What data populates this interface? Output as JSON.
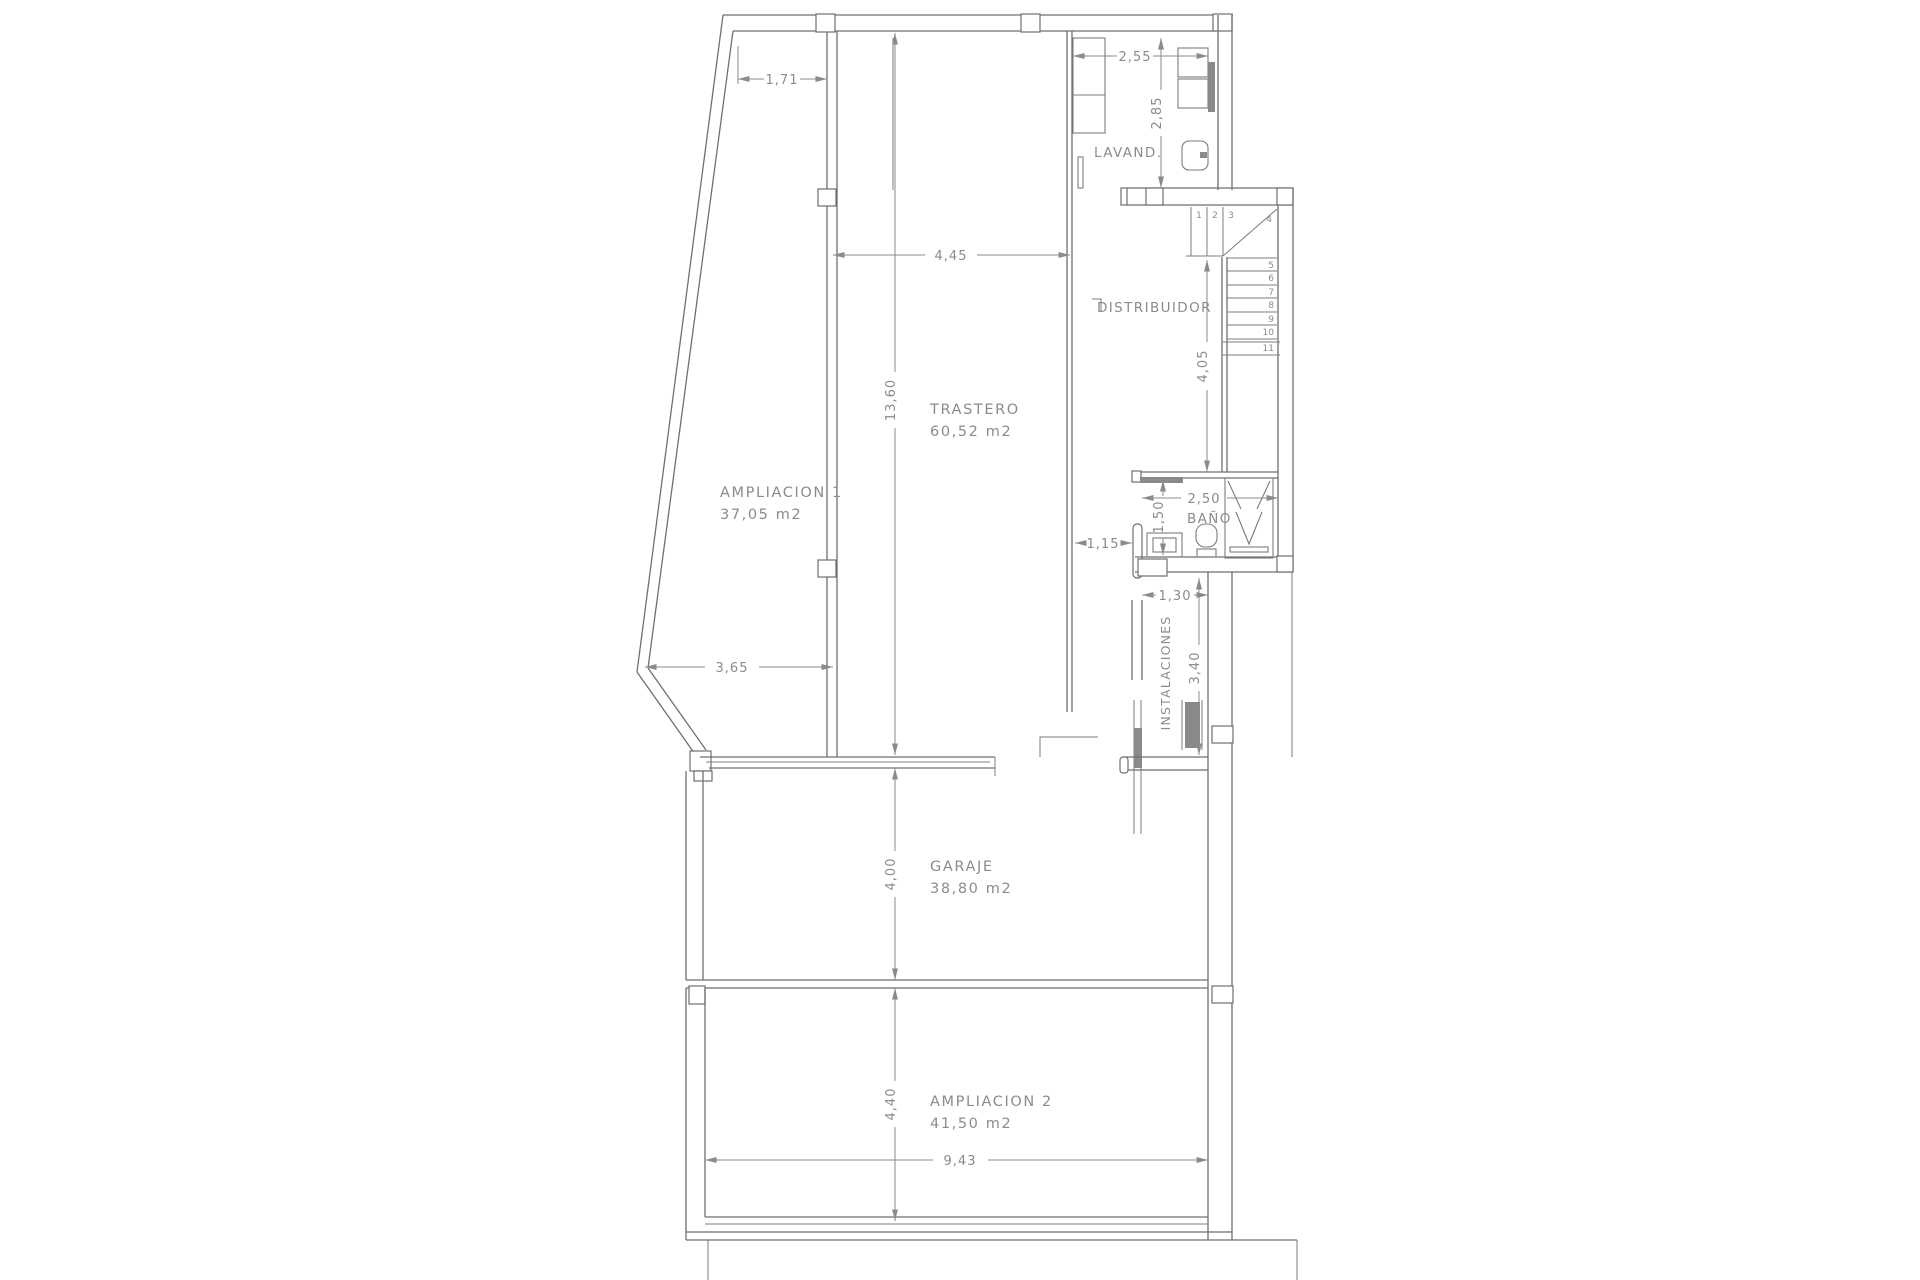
{
  "plan": {
    "rooms": {
      "lavanderia": {
        "name": "LAVAND."
      },
      "distribuidor": {
        "name": "DISTRIBUIDOR"
      },
      "trastero": {
        "name": "TRASTERO",
        "area": "60,52 m2"
      },
      "ampliacion1": {
        "name": "AMPLIACION 1",
        "area": "37,05 m2"
      },
      "bano": {
        "name": "BAÑO"
      },
      "instalaciones": {
        "name": "INSTALACIONES"
      },
      "garaje": {
        "name": "GARAJE",
        "area": "38,80 m2"
      },
      "ampliacion2": {
        "name": "AMPLIACION 2",
        "area": "41,50 m2"
      }
    },
    "dimensions": {
      "ampliacion1_top_width": "1,71",
      "lavanderia_width": "2,55",
      "lavanderia_depth": "2,85",
      "trastero_width": "4,45",
      "trastero_length": "13,60",
      "stair_shaft_length": "4,05",
      "bano_width": "2,50",
      "bano_depth": "1,50",
      "paso_bano_width": "1,15",
      "instalaciones_width": "1,30",
      "instalaciones_height": "3,40",
      "ampliacion1_bottom_width": "3,65",
      "garaje_depth": "4,00",
      "ampliacion2_depth": "4,40",
      "ampliacion2_width": "9,43"
    },
    "stairs": {
      "steps": [
        "1",
        "2",
        "3",
        "4",
        "5",
        "6",
        "7",
        "8",
        "9",
        "10",
        "11"
      ]
    },
    "colors": {
      "background": "#ffffff",
      "wall_line": "#6f6f6f",
      "dim_line": "#8b8b8b",
      "label_text": "#8b8b8b",
      "fixture_dark": "#8a8a8a"
    }
  }
}
